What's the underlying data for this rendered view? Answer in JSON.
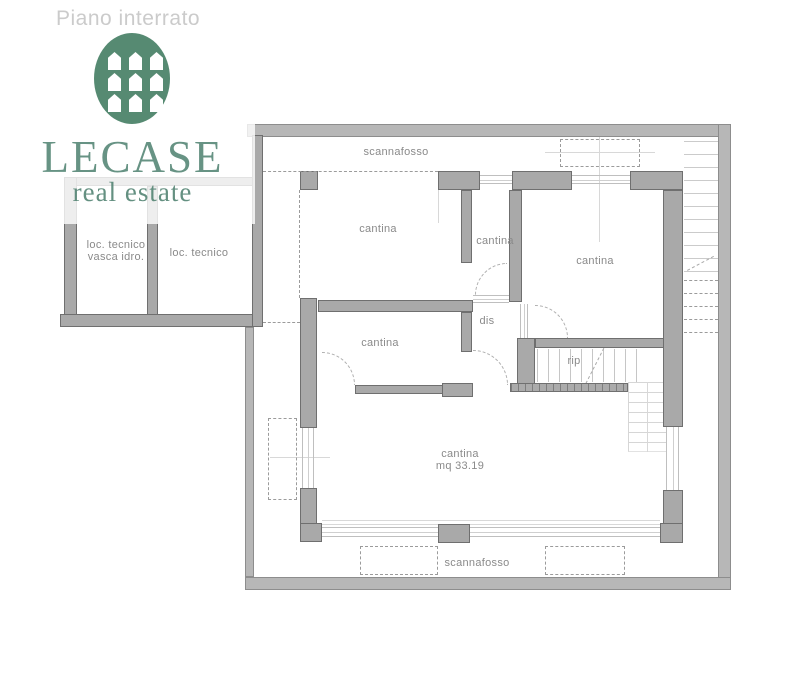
{
  "title": "Piano interrato",
  "logo": {
    "brand": "LECASE",
    "tagline": "real estate",
    "icon": "houses-grid-ellipse",
    "green": "#4e8170"
  },
  "plan": {
    "labels": {
      "scannafosso_top": "scannafosso",
      "scannafosso_bottom": "scannafosso",
      "loc_tecnico_vasca_line1": "loc. tecnico",
      "loc_tecnico_vasca_line2": "vasca idro.",
      "loc_tecnico": "loc. tecnico",
      "cantina_nw": "cantina",
      "cantina_mid_top": "cantina",
      "cantina_ne": "cantina",
      "cantina_mid": "cantina",
      "dis": "dis",
      "rip": "rip",
      "cantina_big_line1": "cantina",
      "cantina_big_line2": "mq 33.19"
    },
    "colors": {
      "outer_wall": "#b7b7b7",
      "inner_wall": "#a9a9a9",
      "wall_edge": "#6f6f6f",
      "dashed_line": "#9b9b9b",
      "label_text": "#8a8a8a",
      "title_text": "#cbcbcb"
    }
  }
}
